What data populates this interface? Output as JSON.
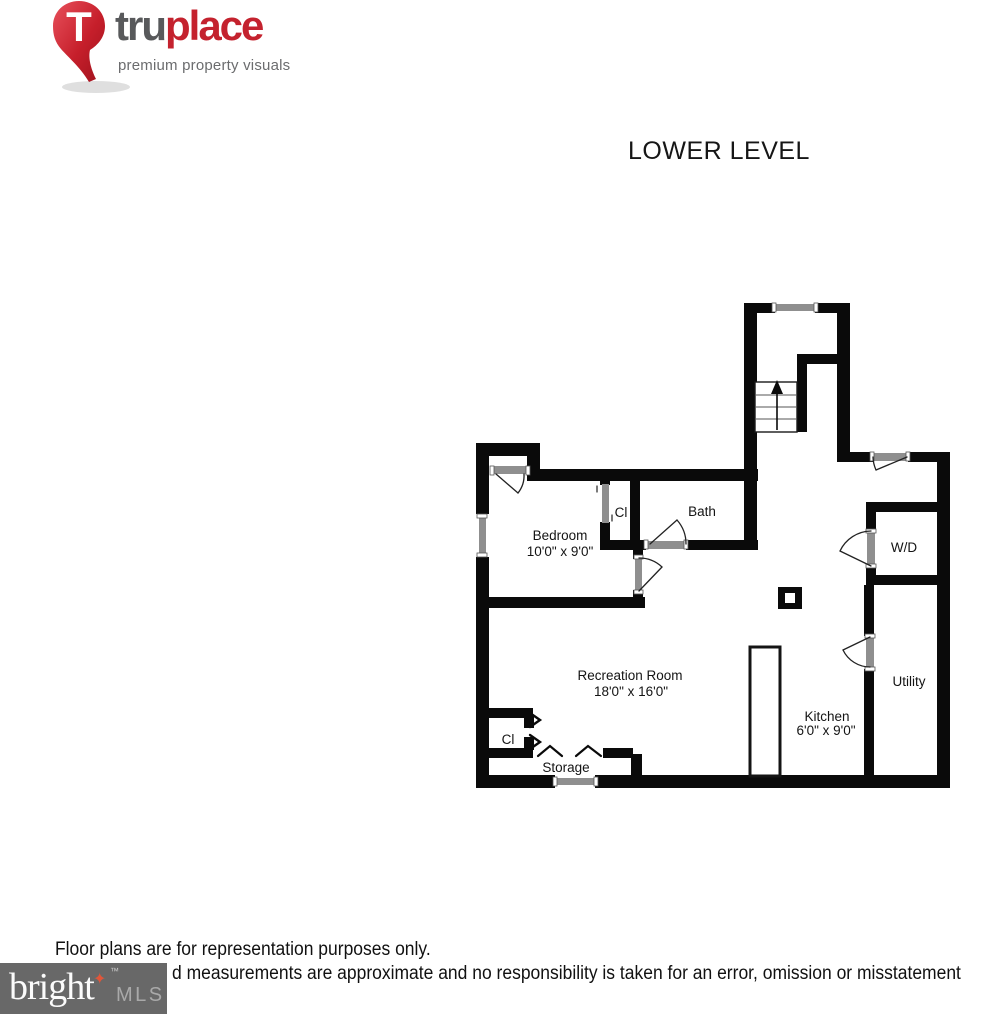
{
  "logo": {
    "brand_bold": "tru",
    "brand_accent": "place",
    "tagline": "premium property visuals",
    "pin_letter": "T",
    "colors": {
      "red": "#c4222e",
      "dark_gray": "#58595b",
      "tagline_gray": "#6b6c6e"
    }
  },
  "title": "LOWER LEVEL",
  "floor_plan": {
    "rooms": [
      {
        "name": "Bedroom",
        "dimensions": "10'0\" x 9'0\""
      },
      {
        "name": "Cl",
        "dimensions": ""
      },
      {
        "name": "Bath",
        "dimensions": ""
      },
      {
        "name": "Recreation Room",
        "dimensions": "18'0\" x 16'0\""
      },
      {
        "name": "Kitchen",
        "dimensions": "6'0\" x 9'0\""
      },
      {
        "name": "W/D",
        "dimensions": ""
      },
      {
        "name": "Utility",
        "dimensions": ""
      },
      {
        "name": "Cl",
        "dimensions": ""
      },
      {
        "name": "Storage",
        "dimensions": ""
      }
    ],
    "wall_color": "#0a0a0a",
    "opening_color": "#8f8f8f"
  },
  "footer": {
    "disclaimer_line1": "Floor plans are for representation purposes only.",
    "disclaimer_line2": "d measurements are approximate and no responsibility is taken for an error, omission or misstatement",
    "mls_logo": {
      "brand": "bright",
      "suffix": "MLS",
      "tm": "™",
      "star_icon": "✦",
      "box_color": "#686868"
    }
  }
}
